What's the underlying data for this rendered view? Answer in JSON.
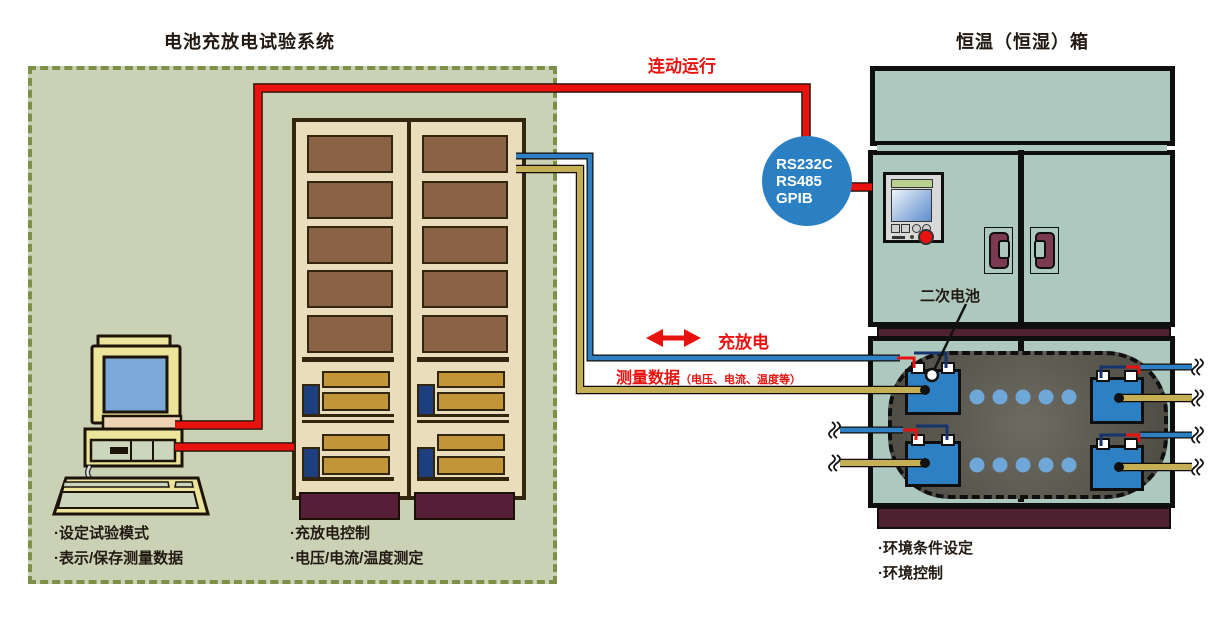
{
  "titles": {
    "system": "电池充放电试验系统",
    "chamber": "恒温（恒湿）箱"
  },
  "cables": {
    "linked_run": "连动运行",
    "charge_discharge": "充放电",
    "measure": "测量数据",
    "measure_detail": "（电压、电流、温度等）"
  },
  "interface_circle": {
    "line1": "RS232C",
    "line2": "RS485",
    "line3": "GPIB"
  },
  "battery_label": "二次电池",
  "notes": {
    "pc1": "·设定试验模式",
    "pc2": "·表示/保存测量数据",
    "rack1": "·充放电控制",
    "rack2": "·电压/电流/温度测定",
    "env1": "·环境条件设定",
    "env2": "·环境控制"
  },
  "colors": {
    "accent_red": "#e8120f",
    "cable_blue": "#2e80c4",
    "cable_yellow": "#c4af55",
    "interface_blue": "#2b80c4",
    "chamber_teal": "#adc8be",
    "system_fill": "#cbd1b5",
    "system_border": "#7e9048",
    "rack_body": "#e9ddbb",
    "rack_panel": "#8a6346",
    "base_maroon": "#571e38"
  }
}
